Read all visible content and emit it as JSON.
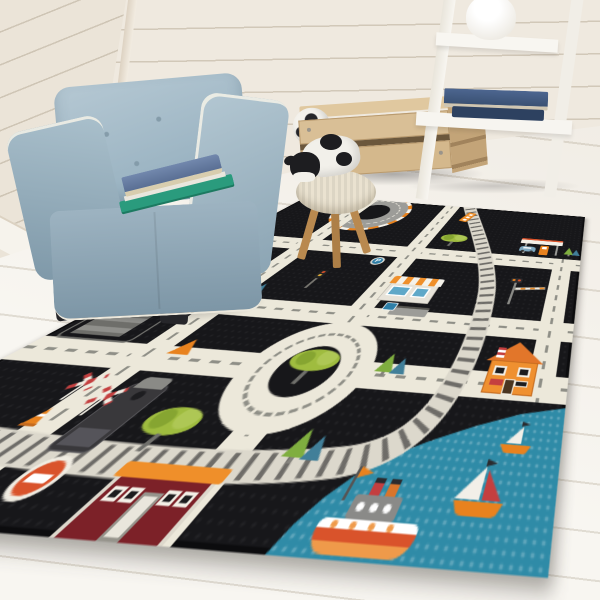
{
  "scene": {
    "type": "photo-recreation",
    "description": "Corner of a kids playroom: blue tufted cube armchair with two books, wooden stool with plush cow and soccer-ball toys, wooden crate with soccer ball, white ladder shelf with vase and books, arranged around a black kids road-play rug featuring roads, a roundabout, a railway, buildings, trees, traffic signs and a harbor corner with boats",
    "wall": {
      "style": "white shiplap planks",
      "color": "#efe9df"
    },
    "floor": {
      "style": "whitewashed wood planks",
      "color": "#f5f2ec"
    }
  },
  "furniture": {
    "armchair": {
      "label": "blue tufted cube armchair",
      "fabric_color": "#8fa9b8",
      "piping_color": "#eee9dd",
      "books_on_seat": [
        {
          "label": "blue book",
          "cover_color": "#65799e"
        },
        {
          "label": "green book",
          "cover_color": "#2a9b7d"
        }
      ]
    },
    "stool": {
      "label": "wooden stool with knitted top",
      "wood_color": "#b9894f",
      "knit_color": "#eae2d0",
      "toys": [
        {
          "label": "plush cow",
          "colors": [
            "#f2f0ea",
            "#1d1d20"
          ]
        },
        {
          "label": "plush soccer ball",
          "colors": [
            "#f4f2ec",
            "#2a2a2a"
          ]
        }
      ]
    },
    "crate": {
      "label": "wooden storage crate with soccer ball",
      "wood_color": "#d9bf96"
    },
    "shelf": {
      "label": "white leaning ladder shelf",
      "color": "#f5f3ed",
      "items": [
        {
          "label": "white vase"
        },
        {
          "label": "navy book stack",
          "cover_color": "#3a5173"
        }
      ]
    }
  },
  "rug": {
    "label": "black kids road play rug",
    "base_color": "#17171a",
    "road_color": "#ece8da",
    "road_dash_color": "#8f8f87",
    "rail_bed_color": "#dcd8cc",
    "rail_tie_color": "#6e6c68",
    "water_color": "#2f8ba7",
    "accent_orange": "#ef8f2a",
    "accent_red": "#c43f3f",
    "sign_blue": "#2e7fa8",
    "signs": {
      "parking_letter": "P"
    },
    "features": [
      "grid of cream roads with dashed center lines",
      "roundabout with tree island",
      "race track loop with striped curb",
      "railway track curving from top edge around the harbor",
      "gray parking garage with orange car sign",
      "shop with orange striped awning",
      "bus stop shelter with blue sign",
      "gas station with fuel pump and small car",
      "orange house with gable roof",
      "dark red fire station with orange roof",
      "train engine and orange rail car",
      "two railroad crossbuck signs",
      "crossing barrier signal",
      "traffic light",
      "orange warning triangle",
      "no-entry sign",
      "traffic cone",
      "blue parking sign",
      "green broccoli trees and green-blue pine trees",
      "teal harbor water with steamboat and two sailboats"
    ]
  }
}
